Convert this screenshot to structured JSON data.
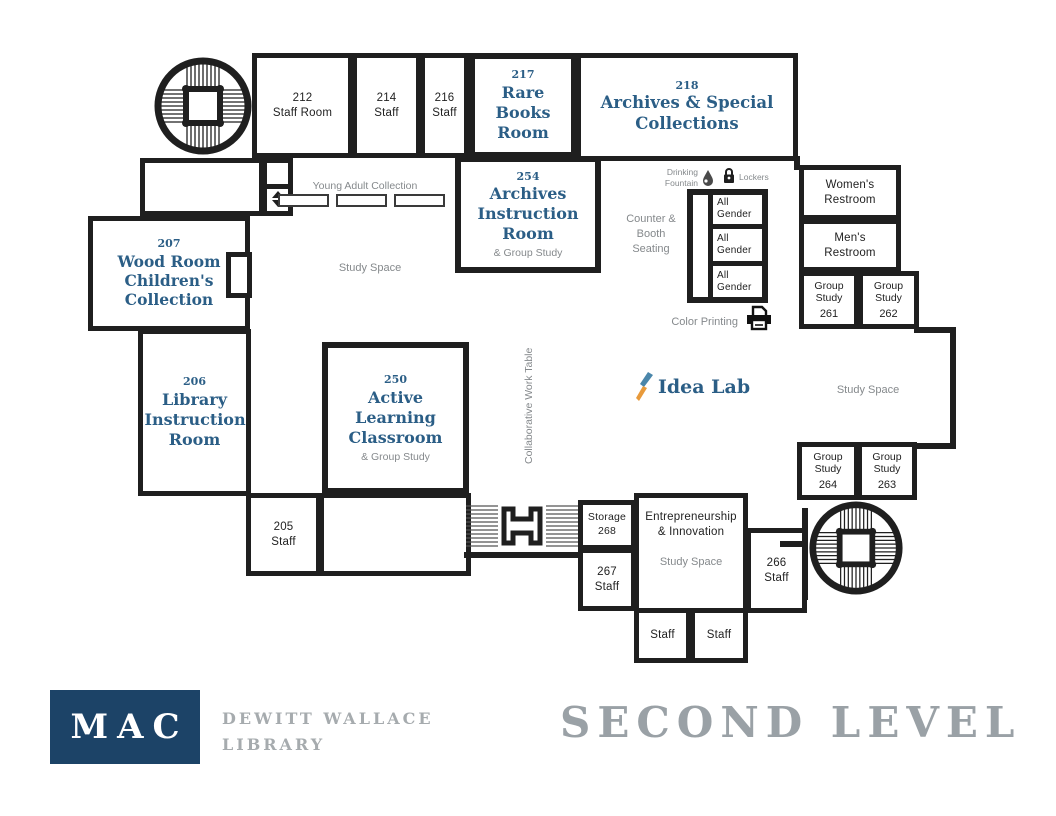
{
  "colors": {
    "wall": "#1f1f1f",
    "room_title_blue": "#2b5e86",
    "muted_gray": "#85898c",
    "logo_navy": "#1c4367",
    "footer_gray": "#9aa1a6",
    "idea_blue": "#4a86aa",
    "idea_orange": "#e89a3b"
  },
  "rooms": {
    "staff_212": {
      "num": "212",
      "label": "Staff Room"
    },
    "staff_214": {
      "num": "214",
      "label": "Staff"
    },
    "staff_216": {
      "num": "216",
      "label": "Staff"
    },
    "rare_books_217": {
      "num": "217",
      "label": "Rare Books Room"
    },
    "archives_218": {
      "num": "218",
      "label": "Archives & Special Collections"
    },
    "archives_instruction_254": {
      "num": "254",
      "label": "Archives Instruction Room",
      "sub": "& Group Study"
    },
    "wood_room_207": {
      "num": "207",
      "label": "Wood Room Children's Collection"
    },
    "library_instruction_206": {
      "num": "206",
      "label": "Library Instruction Room"
    },
    "active_learning_250": {
      "num": "250",
      "label": "Active Learning Classroom",
      "sub": "& Group Study"
    },
    "staff_205": {
      "num": "205",
      "label": "Staff"
    },
    "storage_268": {
      "label": "Storage",
      "num": "268"
    },
    "staff_267": {
      "num": "267",
      "label": "Staff"
    },
    "staff_266": {
      "num": "266",
      "label": "Staff"
    },
    "staff_bottom_left": {
      "label": "Staff"
    },
    "staff_bottom_right": {
      "label": "Staff"
    },
    "entrepreneurship": {
      "label": "Entrepreneurship & Innovation",
      "sub": "Study Space"
    },
    "womens_restroom": {
      "label": "Women's Restroom"
    },
    "mens_restroom": {
      "label": "Men's Restroom"
    },
    "group_study_261": {
      "label": "Group Study",
      "num": "261"
    },
    "group_study_262": {
      "label": "Group Study",
      "num": "262"
    },
    "group_study_263": {
      "label": "Group Study",
      "num": "263"
    },
    "group_study_264": {
      "label": "Group Study",
      "num": "264"
    },
    "all_gender": [
      "All Gender",
      "All Gender",
      "All Gender"
    ]
  },
  "areas": {
    "young_adult": "Young Adult Collection",
    "study_space_main": "Study Space",
    "study_space_right": "Study Space",
    "counter_booth": "Counter & Booth Seating",
    "collaborative_table": "Collaborative Work Table",
    "color_printing": "Color Printing",
    "drinking_fountain": "Drinking Fountain",
    "lockers": "Lockers",
    "idea_lab": "Idea Lab"
  },
  "footer": {
    "logo_text": "MAC",
    "library_line1": "DEWITT WALLACE",
    "library_line2": "LIBRARY",
    "level_title": "SECOND LEVEL"
  }
}
